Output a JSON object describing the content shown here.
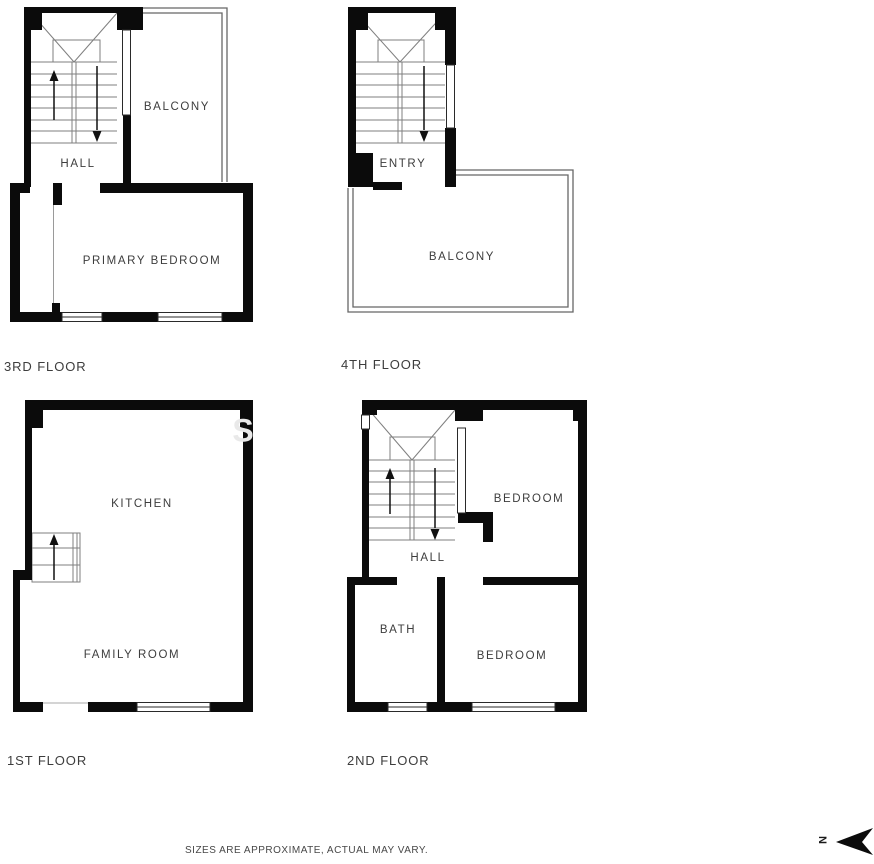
{
  "floors": [
    {
      "caption": "3RD FLOOR",
      "rooms": [
        {
          "label": "HALL"
        },
        {
          "label": "BALCONY"
        },
        {
          "label": "PRIMARY BEDROOM"
        }
      ]
    },
    {
      "caption": "4TH FLOOR",
      "rooms": [
        {
          "label": "ENTRY"
        },
        {
          "label": "BALCONY"
        }
      ]
    },
    {
      "caption": "1ST FLOOR",
      "rooms": [
        {
          "label": "KITCHEN"
        },
        {
          "label": "FAMILY ROOM"
        }
      ]
    },
    {
      "caption": "2ND FLOOR",
      "rooms": [
        {
          "label": "BEDROOM"
        },
        {
          "label": "HALL"
        },
        {
          "label": "BATH"
        },
        {
          "label": "BEDROOM"
        }
      ]
    }
  ],
  "footer": {
    "disclaimer": "SIZES ARE APPROXIMATE, ACTUAL MAY VARY."
  },
  "compass": {
    "label": "N"
  },
  "watermark": {
    "text": "S"
  },
  "colors": {
    "wall": "#0b0b0b",
    "stair_line": "#7f7f7f",
    "railing": "#666666",
    "window_stroke": "#2a2a2a",
    "text": "#3d3d3d"
  }
}
